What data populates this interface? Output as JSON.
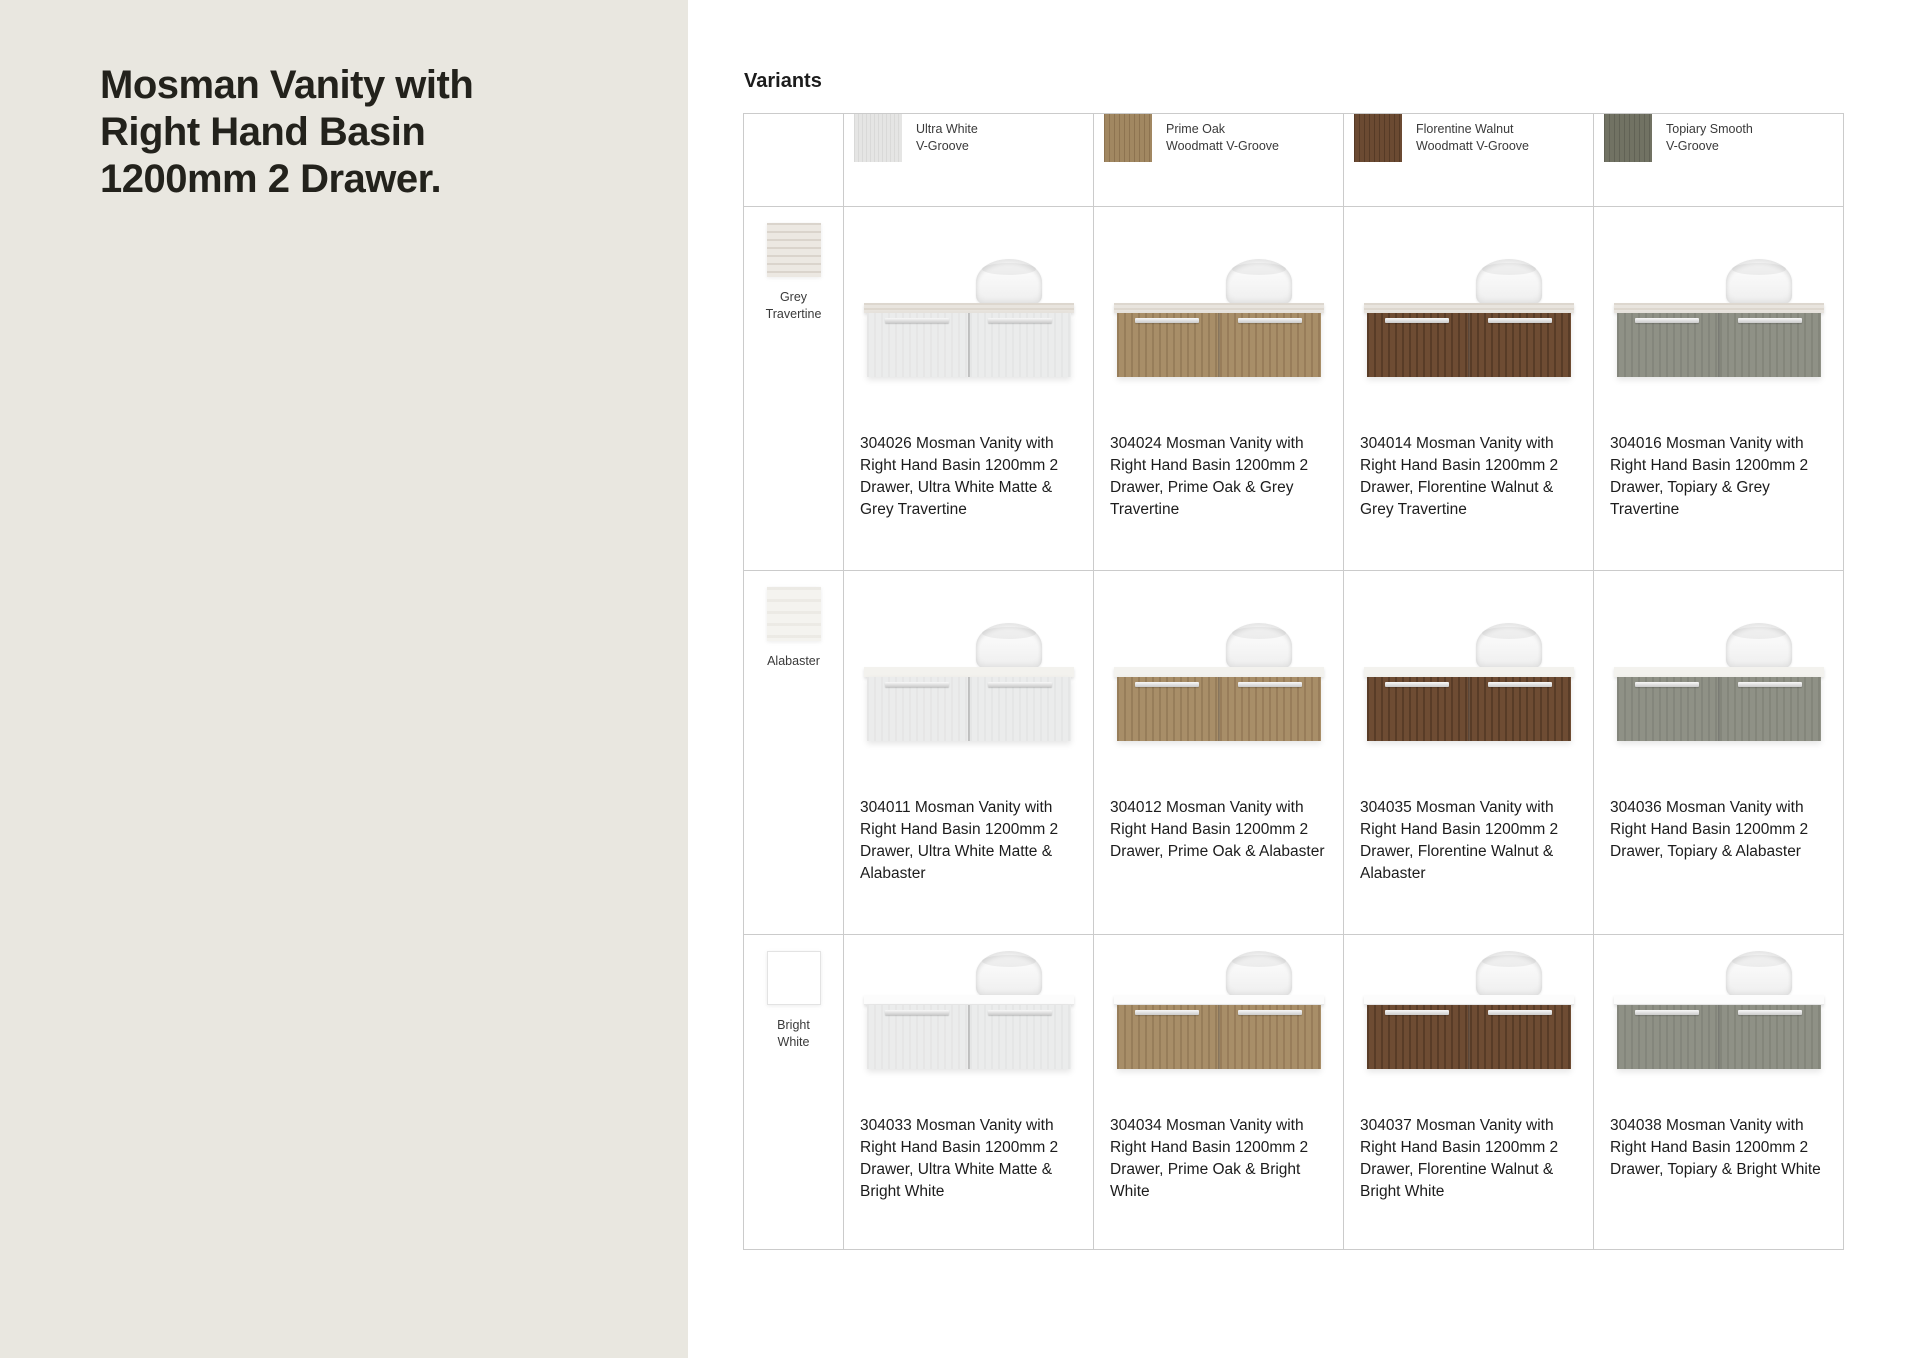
{
  "page": {
    "title": "Mosman Vanity with Right Hand Basin 1200mm 2 Drawer.",
    "section_heading": "Variants"
  },
  "colors": {
    "left_panel_bg": "#e9e7e0",
    "content_bg": "#ffffff",
    "table_border": "#cbcbcb",
    "title_text": "#23221c",
    "body_text": "#1c1c1c",
    "finish_ultra_white": "#e5e5e4",
    "finish_prime_oak": "#a18761",
    "finish_florentine_walnut": "#6b4a32",
    "finish_topiary": "#717263",
    "top_grey_travertine": "#e8e4de",
    "top_alabaster": "#f3f2ee",
    "top_bright_white": "#fcfcfc"
  },
  "columns": [
    {
      "id": "ultra-white",
      "label_line1": "Ultra White",
      "label_line2": "V-Groove"
    },
    {
      "id": "prime-oak",
      "label_line1": "Prime Oak",
      "label_line2": "Woodmatt V-Groove"
    },
    {
      "id": "florentine-walnut",
      "label_line1": "Florentine Walnut",
      "label_line2": "Woodmatt V-Groove"
    },
    {
      "id": "topiary",
      "label_line1": "Topiary Smooth",
      "label_line2": "V-Groove"
    }
  ],
  "rows": [
    {
      "id": "grey-travertine",
      "label": "Grey Travertine"
    },
    {
      "id": "alabaster",
      "label": "Alabaster"
    },
    {
      "id": "bright-white",
      "label": "Bright White"
    }
  ],
  "cells": [
    [
      "304026 Mosman Vanity with Right Hand Basin 1200mm 2 Drawer, Ultra White Matte & Grey Travertine",
      "304024 Mosman Vanity with Right Hand Basin 1200mm 2 Drawer, Prime Oak & Grey Travertine",
      "304014 Mosman Vanity with Right Hand Basin 1200mm 2 Drawer, Florentine Walnut & Grey Travertine",
      "304016 Mosman Vanity with Right Hand Basin 1200mm 2 Drawer, Topiary & Grey Travertine"
    ],
    [
      "304011 Mosman Vanity with Right Hand Basin 1200mm 2 Drawer, Ultra White Matte & Alabaster",
      "304012 Mosman Vanity with Right Hand Basin 1200mm 2 Drawer, Prime Oak & Alabaster",
      "304035 Mosman Vanity with Right Hand Basin 1200mm 2 Drawer, Florentine Walnut & Alabaster",
      "304036 Mosman Vanity with Right Hand Basin 1200mm 2 Drawer, Topiary & Alabaster"
    ],
    [
      "304033 Mosman Vanity with Right Hand Basin 1200mm 2 Drawer, Ultra White Matte & Bright White",
      "304034 Mosman Vanity with Right Hand Basin 1200mm 2 Drawer, Prime Oak & Bright White",
      "304037 Mosman Vanity with Right Hand Basin 1200mm 2 Drawer, Florentine Walnut & Bright White",
      "304038 Mosman Vanity with Right Hand Basin 1200mm 2 Drawer, Topiary & Bright White"
    ]
  ]
}
